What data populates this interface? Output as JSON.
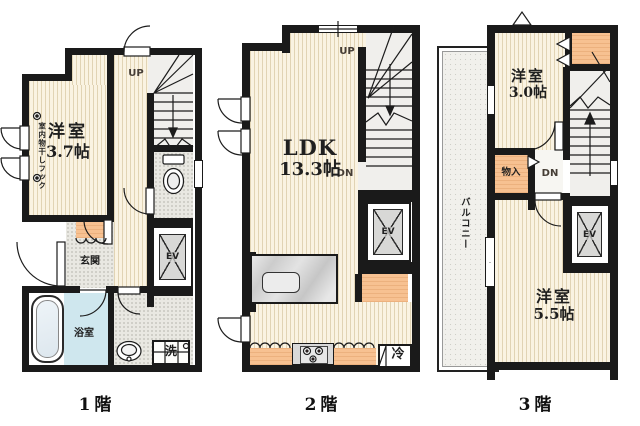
{
  "palette": {
    "wall": "#1a1a1a",
    "tatami": "#faf3e2",
    "tile_gray": "#e9e8e2",
    "stair_gray": "#f0efec",
    "accent_orange": "#f7c191",
    "bath_blue": "#cfe7ee",
    "marble_gray": "#d8d8d8",
    "balcony": "#f1f0ec"
  },
  "floors": [
    {
      "label": "1階",
      "room": {
        "name": "洋室",
        "size": "3.7帖"
      },
      "hook_note": "室内物干しフック",
      "up": "UP",
      "entrance": "玄関",
      "elevator": "EV",
      "bathroom": "浴室",
      "laundry": "洗"
    },
    {
      "label": "2階",
      "room": {
        "name": "LDK",
        "size": "13.3帖"
      },
      "up": "UP",
      "down": "DN",
      "elevator": "EV",
      "fridge": "冷"
    },
    {
      "label": "3階",
      "room_small": {
        "name": "洋室",
        "size": "3.0帖"
      },
      "room_large": {
        "name": "洋室",
        "size": "5.5帖"
      },
      "closet": "物入",
      "balcony": "バルコニー",
      "down": "DN",
      "elevator": "EV"
    }
  ]
}
